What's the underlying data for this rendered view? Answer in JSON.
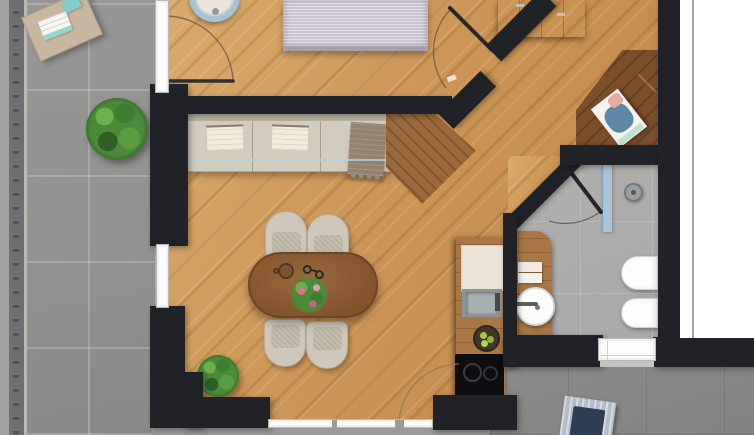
{
  "scene": {
    "title": "3D top-down floor plan rendering of an apartment: left balcony with railing, bedroom at top, open living-dining room with diagonal hallway, kitchenette, bathroom and a lower terrace at bottom right",
    "type": "architectural-floor-plan-render",
    "visible_text": []
  },
  "palette": {
    "wall": "#212227",
    "wood-light": "#d9ad6e",
    "wood-mid": "#cb9557",
    "wood-dark": "#bd8647",
    "tile-terrace": "#929290",
    "tile-terrace-dark": "#828280",
    "tile-bath": "#a9a8a6",
    "railing": "#6f6f71",
    "window-white": "#fdfdfd",
    "glass-blue": "#a9c6dc",
    "sofa-beige": "#d2ccbe",
    "cushion-cream": "#f1ebdb",
    "throw-brown": "#95826f",
    "chair-beige": "#cfc8ba",
    "table-brown": "#82532c",
    "counter-wood": "#a87745",
    "cooktop-black": "#0e0e10",
    "fixture-white": "#fdfdfb",
    "plant-green": "#4a8a39",
    "flower-pink": "#d9748f",
    "accent-teal": "#7fd0ca",
    "bed-lilac": "#c9c4ce",
    "lounger-navy": "#2f3d57",
    "margin-white": "#ffffff"
  },
  "rooms": [
    {
      "id": "balcony",
      "name": "Balcony terrace (left)",
      "floor": "grey stone tile",
      "features": [
        "railing with balusters",
        "coffee table with magazine",
        "potted plant"
      ]
    },
    {
      "id": "bedroom",
      "name": "Bedroom (top)",
      "floor": "oak parquet",
      "features": [
        "bed with striped lilac cover",
        "round blue-rimmed pouf",
        "wardrobe with handles"
      ]
    },
    {
      "id": "living",
      "name": "Living / dining room",
      "floor": "oak parquet",
      "features": [
        "beige wall sofa",
        "oval dining table",
        "four tub chairs",
        "wood sideboard",
        "floor plant"
      ]
    },
    {
      "id": "kitchen",
      "name": "Kitchenette",
      "floor": "oak parquet",
      "features": [
        "counter strip",
        "sink",
        "two-burner cooktop",
        "fruit bowl"
      ]
    },
    {
      "id": "hallway",
      "name": "Diagonal hallway",
      "floor": "oak parquet",
      "features": [
        "corner desk",
        "book on desk"
      ]
    },
    {
      "id": "bathroom",
      "name": "Bathroom",
      "floor": "grey tile",
      "features": [
        "glass shower panel",
        "shower head",
        "wood vanity with round basin",
        "towels",
        "toilet",
        "bidet"
      ]
    },
    {
      "id": "terrace-low",
      "name": "Lower terrace (bottom right)",
      "floor": "dark grey tile",
      "features": [
        "sun lounger with navy cushion"
      ]
    }
  ],
  "furniture": [
    {
      "id": "terrace-table",
      "name": "balcony coffee table with magazine and teal card",
      "room": "balcony"
    },
    {
      "id": "terrace-plant",
      "name": "green potted plant",
      "room": "balcony"
    },
    {
      "id": "round-pouf",
      "name": "round pouf with light-blue rim",
      "room": "bedroom"
    },
    {
      "id": "bed",
      "name": "bed with striped lilac cover (cut by top edge)",
      "room": "bedroom"
    },
    {
      "id": "wardrobe",
      "name": "wardrobe / chest with metal handles",
      "room": "bedroom"
    },
    {
      "id": "sofa",
      "name": "beige bench sofa with two cream cushions and brown throw",
      "room": "living"
    },
    {
      "id": "sideboard",
      "name": "angled wood sideboard",
      "room": "living"
    },
    {
      "id": "dining-table",
      "name": "oval walnut dining table with mug, eyeglasses and flower centerpiece",
      "room": "living"
    },
    {
      "id": "dining-chairs",
      "name": "four beige tub chairs",
      "room": "living"
    },
    {
      "id": "floor-plant",
      "name": "potted plant near bottom wall",
      "room": "living"
    },
    {
      "id": "kitchen-counter",
      "name": "kitchen counter with cutting board, sink, fruit bowl, cooktop",
      "room": "kitchen"
    },
    {
      "id": "corner-desk",
      "name": "dark wood corner desk with book",
      "room": "hallway"
    },
    {
      "id": "vanity",
      "name": "wood vanity with round white basin and two towels",
      "room": "bathroom"
    },
    {
      "id": "toilet",
      "name": "wall-hung toilet",
      "room": "bathroom"
    },
    {
      "id": "bidet",
      "name": "wall-hung bidet",
      "room": "bathroom"
    },
    {
      "id": "shower",
      "name": "shower with blue glass panel and round head",
      "room": "bathroom"
    },
    {
      "id": "sun-lounger",
      "name": "sun lounger with navy cushion (cut by bottom edge)",
      "room": "terrace-low"
    }
  ],
  "openings": [
    {
      "name": "balcony window next to bedroom",
      "type": "window"
    },
    {
      "name": "balcony door with swing arc (top left)",
      "type": "door"
    },
    {
      "name": "balcony window next to living room",
      "type": "window"
    },
    {
      "name": "bedroom door with swing arc (diagonal wall)",
      "type": "door"
    },
    {
      "name": "bathroom door with swing arc",
      "type": "door"
    },
    {
      "name": "terrace glazing strip (bottom)",
      "type": "window"
    },
    {
      "name": "terrace door with swing arc (bottom)",
      "type": "door"
    },
    {
      "name": "bathroom window (bottom wall)",
      "type": "window"
    }
  ]
}
